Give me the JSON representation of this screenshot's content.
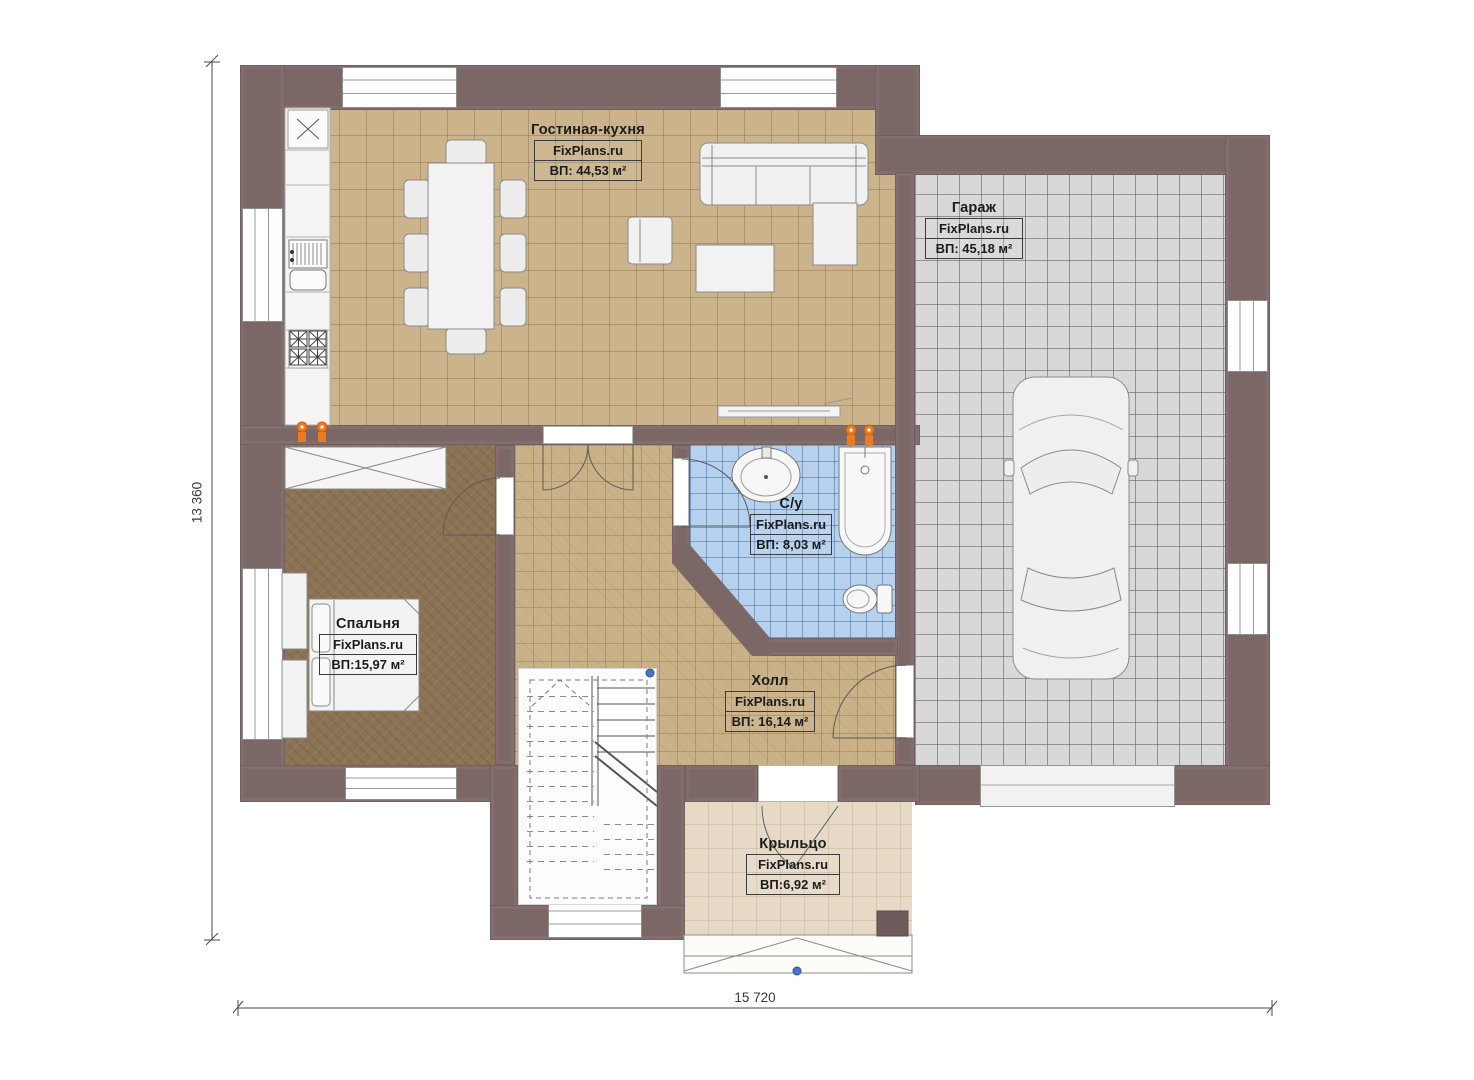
{
  "plan": {
    "kind": "floor-plan",
    "watermark": "FixPlans.ru"
  },
  "rooms": [
    {
      "name": "Гостиная-кухня",
      "brand": "FixPlans.ru",
      "area": "ВП: 44,53 м²"
    },
    {
      "name": "Гараж",
      "brand": "FixPlans.ru",
      "area": "ВП: 45,18 м²"
    },
    {
      "name": "С/у",
      "brand": "FixPlans.ru",
      "area": "ВП: 8,03 м²"
    },
    {
      "name": "Спальня",
      "brand": "FixPlans.ru",
      "area": "ВП:15,97 м²"
    },
    {
      "name": "Холл",
      "brand": "FixPlans.ru",
      "area": "ВП: 16,14 м²"
    },
    {
      "name": "Крыльцо",
      "brand": "FixPlans.ru",
      "area": "ВП:6,92 м²"
    }
  ],
  "dimensions": {
    "overall_width": "15 720",
    "overall_height": "13 360"
  },
  "kitchen": {
    "cabinet_mark": "×"
  },
  "colors": {
    "wall": "#7c6767",
    "living_floor": "#cbb48c",
    "bedroom_floor": "#8b7353",
    "bathroom_floor": "#b5d1ee",
    "garage_floor": "#d8d8d8",
    "porch_floor": "#e6dac6",
    "accent_orange": "#ee7a1f",
    "marker_blue": "#4a72c8"
  },
  "fixtures": [
    "dining-table",
    "chairs",
    "corner-sofa",
    "armchair",
    "coffee-table",
    "tv-shelf",
    "fridge",
    "kitchen-sink",
    "stove",
    "wardrobe",
    "bed",
    "nightstands",
    "wash-basin",
    "bathtub",
    "toilet",
    "car",
    "staircase",
    "porch-steps"
  ]
}
